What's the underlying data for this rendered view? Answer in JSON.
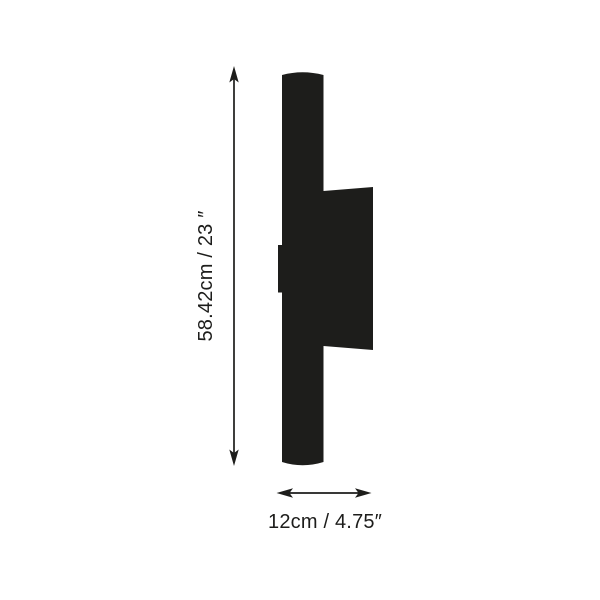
{
  "colors": {
    "ink": "#1d1d1b",
    "background": "#ffffff"
  },
  "dimensions": {
    "height_label": "58.42cm / 23 ″",
    "width_label": "12cm / 4.75″"
  }
}
